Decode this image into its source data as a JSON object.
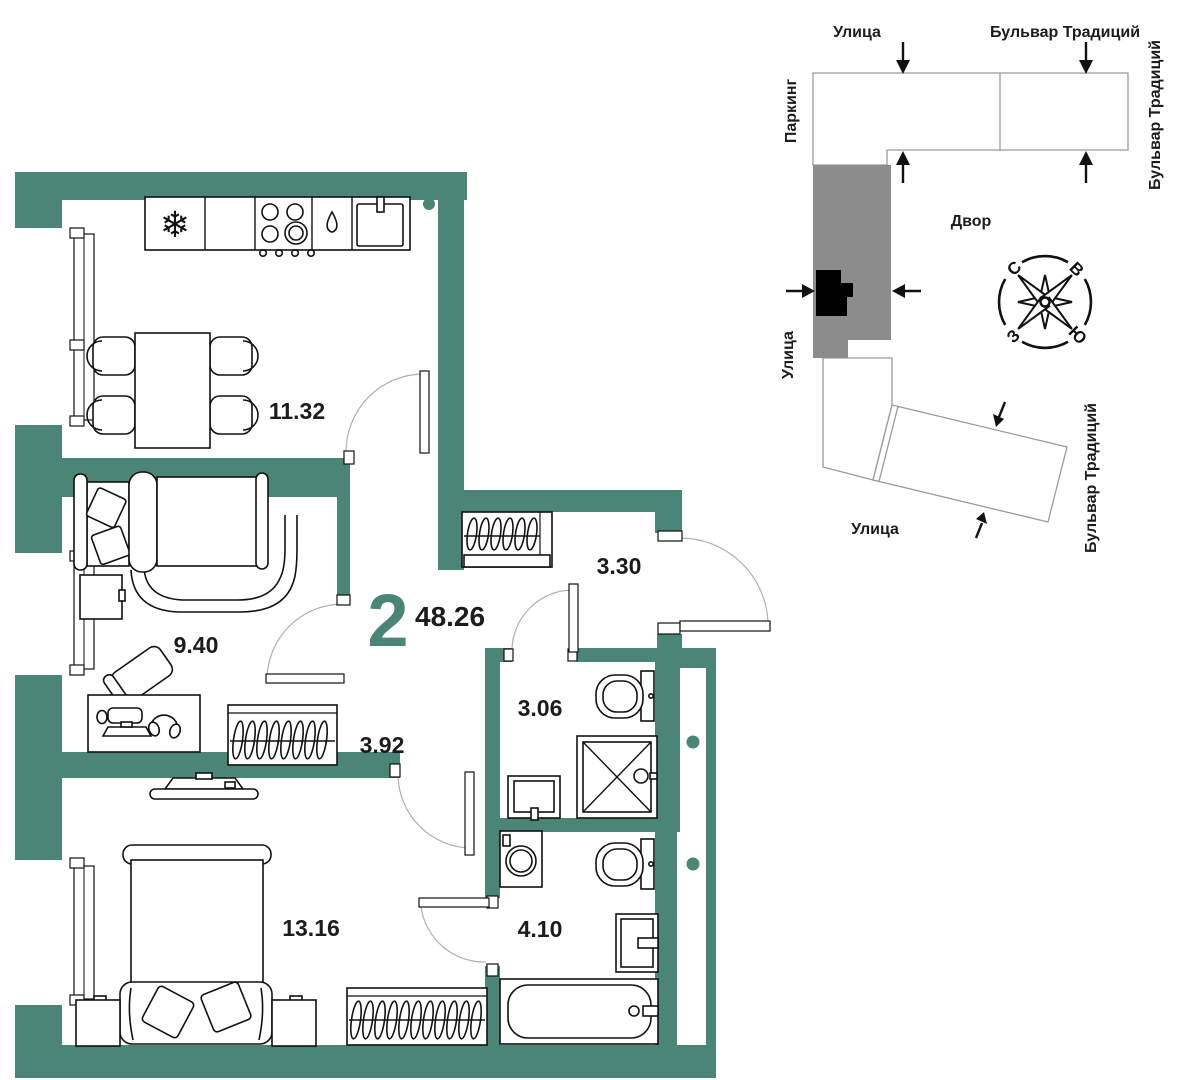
{
  "plan": {
    "unit_number": "2",
    "total_area": "48.26",
    "rooms": [
      {
        "id": "kitchen-dining",
        "area": "11.32"
      },
      {
        "id": "living-room",
        "area": "9.40"
      },
      {
        "id": "hallway",
        "area": "3.30"
      },
      {
        "id": "corridor",
        "area": "3.92"
      },
      {
        "id": "bathroom-small",
        "area": "3.06"
      },
      {
        "id": "bedroom",
        "area": "13.16"
      },
      {
        "id": "bathroom-large",
        "area": "4.10"
      }
    ]
  },
  "site": {
    "street_top": "Улица",
    "boulevard_top": "Бульвар Традиций",
    "parking": "Паркинг",
    "boulevard_right": "Бульвар Традиций",
    "street_left": "Улица",
    "courtyard": "Двор",
    "street_bottom": "Улица",
    "boulevard_bottom_right": "Бульвар Традиций",
    "compass": {
      "north": "С",
      "east": "В",
      "south": "Ю",
      "west": "З"
    }
  },
  "colors": {
    "wall_teal": "#4A8577",
    "building_gray": "#8C8C8C",
    "unit_highlight": "#000000"
  }
}
